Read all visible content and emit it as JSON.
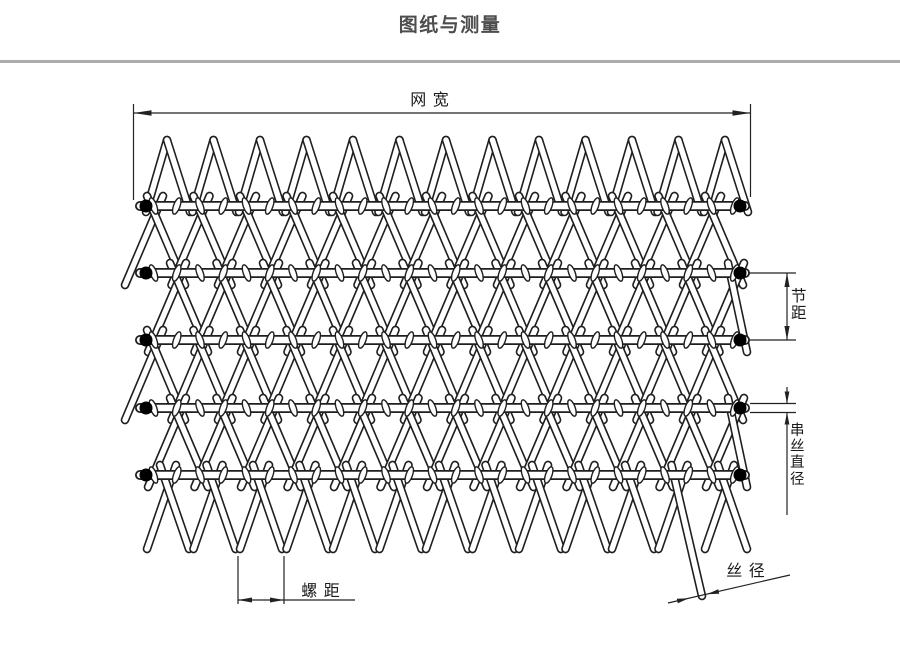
{
  "title": "图纸与测量",
  "drawing": {
    "labels": {
      "net_width": "网 宽",
      "pitch": "节距",
      "cross_wire_diameter": "串丝直径",
      "spiral_pitch": "螺 距",
      "wire_diameter": "丝 径"
    },
    "colors": {
      "line": "#1f1f1f",
      "wire_fill": "#ffffff",
      "dim_line": "#222222",
      "dot": "#000000",
      "title_text": "#4d4d4d",
      "label_text": "#1a1a1a",
      "divider": "#ababab",
      "background": "#ffffff"
    },
    "structure": {
      "cross_rods": 5,
      "spiral_peaks_per_row": 13,
      "zigzag_bands": 6,
      "edge_dots_per_rod": 2
    }
  }
}
